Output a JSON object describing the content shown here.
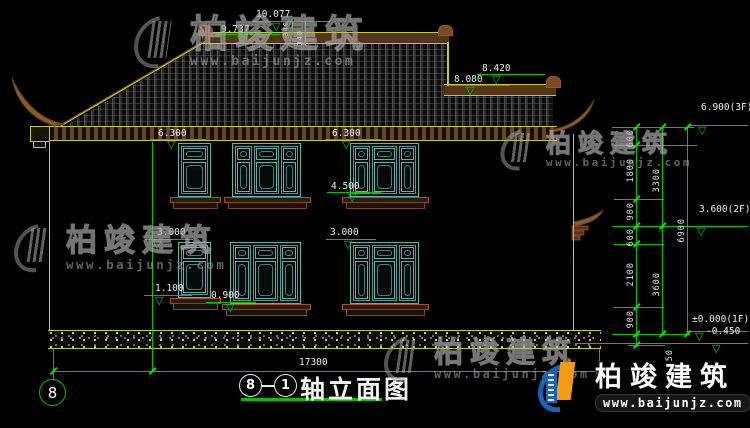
{
  "brand": {
    "name": "柏竣建筑",
    "url": "www.baijunjz.com"
  },
  "title_block": {
    "axis_from": "8",
    "axis_to": "1",
    "title": "轴立面图"
  },
  "axis_bubble_left": "8",
  "dims": {
    "total_width": "17300",
    "levels": {
      "ridge_top": "10.077",
      "ridge_bottom": "9.737",
      "wing_ridge_top": "8.420",
      "wing_ridge_bottom": "8.080",
      "eave_left": "6.300",
      "eave_right": "6.300",
      "window2f_sill": "4.500",
      "window1f_top_left": "3.000",
      "window1f_top_right": "3.000",
      "window1f_sill_narrow": "1.100",
      "window1f_sill_wide": "0.900"
    },
    "floor_levels": {
      "f3": "6.900(3F)",
      "f2": "3.600(2F)",
      "f1": "±0.000(1F)",
      "ground": "-0.450"
    },
    "chain": {
      "seg1": "600",
      "seg2": "1800",
      "seg3": "900",
      "seg4": "600",
      "seg5": "2100",
      "seg6": "900",
      "seg7": "450",
      "floor2_height": "3300",
      "floor1_height": "3600",
      "total_height": "6900"
    },
    "ridge_small_a": "340",
    "ridge_small_b": "340"
  }
}
